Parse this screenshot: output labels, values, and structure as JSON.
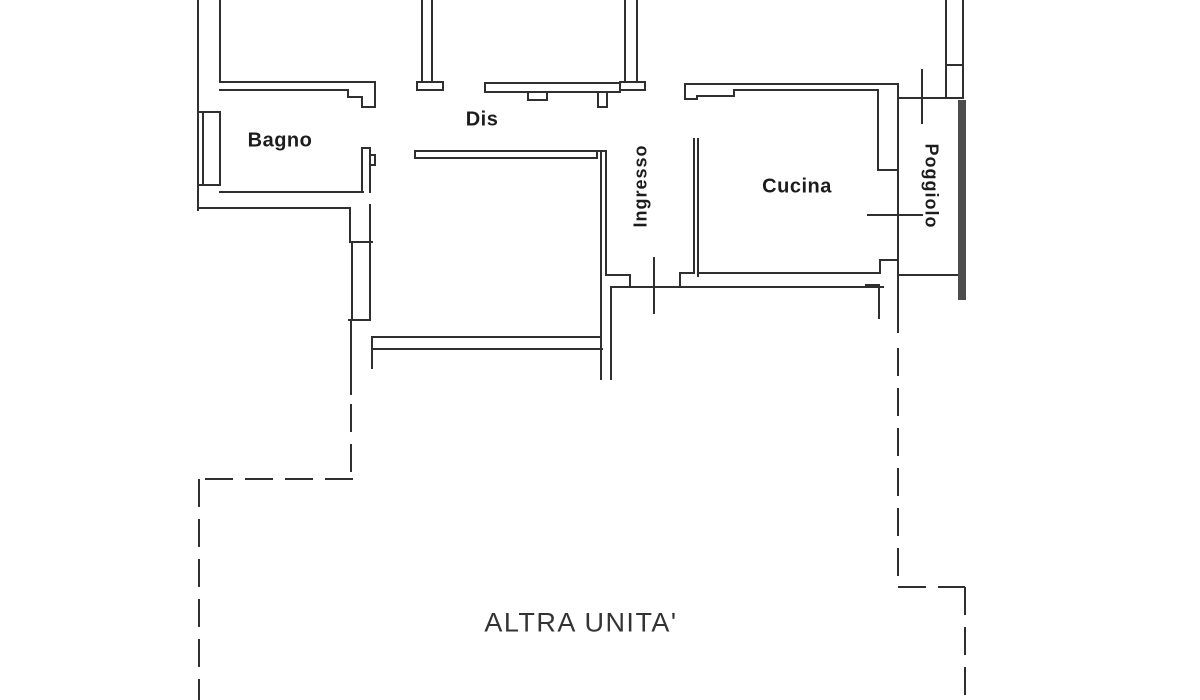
{
  "rooms": {
    "bagno": "Bagno",
    "dis": "Dis",
    "ingresso": "Ingresso",
    "cucina": "Cucina",
    "poggiolo": "Poggiolo"
  },
  "other_unit": {
    "label": "ALTRA UNITA'"
  },
  "colors": {
    "background": "#ffffff",
    "wall_line": "#2f2f2f",
    "thick_wall": "#4d4d4d",
    "label_text": "#1c1c1c",
    "other_unit_text": "#333333"
  }
}
